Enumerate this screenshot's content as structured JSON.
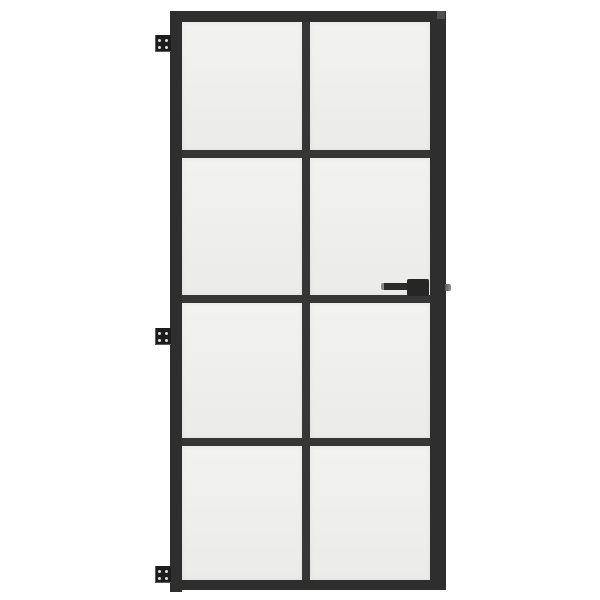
{
  "colors": {
    "bg": "#ffffff",
    "frame": "#2e2e2e",
    "muntin": "#363636",
    "glass-light": "#f2f2f0",
    "glass-dark": "#ebebe9",
    "hinge": "#1d1d1d",
    "screw": "#dfdfdf",
    "handle": "#262626",
    "lever": "#2c2c2c",
    "lever-tip": "#8a8a8a",
    "spindle": "#5c5c5c",
    "edge-cap": "#515151"
  },
  "scene": {
    "type": "product-photo",
    "background": "white seamless"
  },
  "door": {
    "description": "Black interior door with eight frosted glass panes arranged in two columns and four rows, three hinges on the left edge and a lever handle on the right stile",
    "pane_columns": 2,
    "pane_rows": 4,
    "pane_count": 8,
    "hinges": {
      "count": 3,
      "positions": [
        "top-left",
        "middle-left",
        "bottom-left"
      ],
      "screws_per_hinge": 4
    },
    "handle": {
      "type": "lever",
      "side": "right",
      "orientation": "pointing-left",
      "has_exterior_spindle_stub": true
    }
  }
}
